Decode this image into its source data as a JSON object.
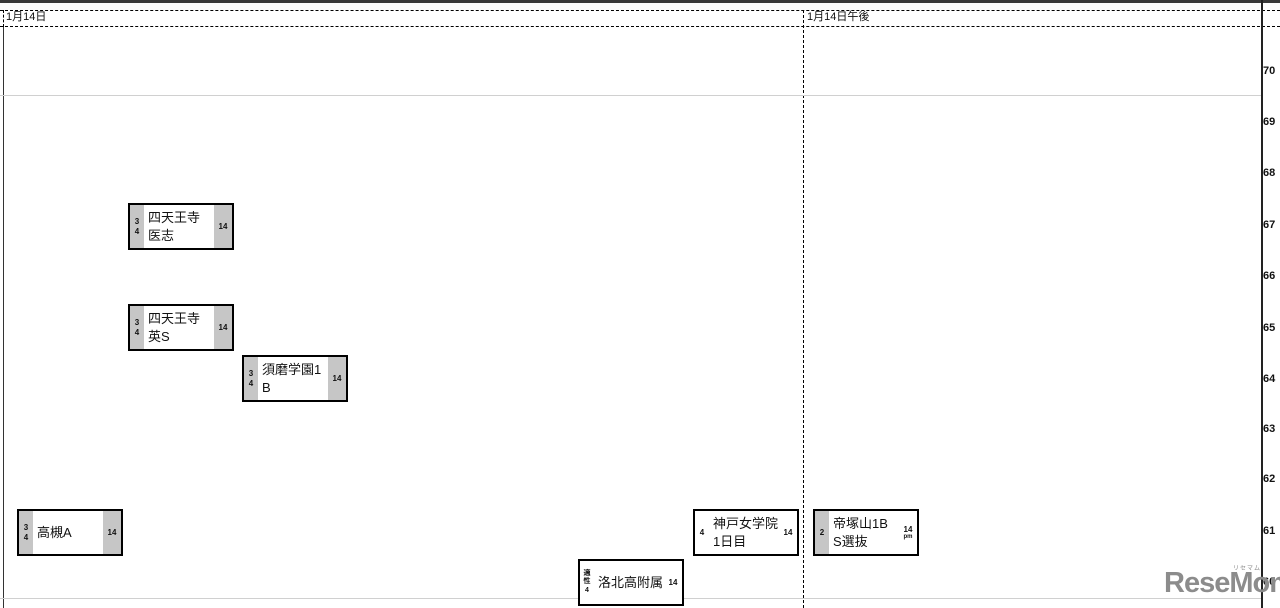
{
  "header": {
    "left_column_label": "1月14日",
    "right_column_label": "1月14日午後"
  },
  "axis": {
    "ticks": [
      "70",
      "69",
      "68",
      "67",
      "66",
      "65",
      "64",
      "63",
      "62",
      "61",
      "60"
    ]
  },
  "boxes": [
    {
      "name": "四天王寺\n医志",
      "left": "3\n4",
      "right": "14",
      "right_sub": ""
    },
    {
      "name": "四天王寺\n英S",
      "left": "3\n4",
      "right": "14",
      "right_sub": ""
    },
    {
      "name": "須磨学園1\nB",
      "left": "3\n4",
      "right": "14",
      "right_sub": ""
    },
    {
      "name": "高槻A",
      "left": "3\n4",
      "right": "14",
      "right_sub": ""
    },
    {
      "name": "神戸女学院\n1日目",
      "left": "4",
      "right": "14",
      "right_sub": ""
    },
    {
      "name": "帝塚山1B\nS選抜",
      "left": "2",
      "right": "14",
      "right_sub": "pm"
    },
    {
      "name": "洛北高附属",
      "left": "適\n性\n4",
      "right": "14",
      "right_sub": ""
    }
  ],
  "watermark": {
    "text": "ReseMom.",
    "ruby": "リセマム"
  },
  "colors": {
    "strip_gray": "#c6c6c6",
    "grid_light": "#d0d0d0",
    "box_border": "#000000",
    "watermark_gray": "#8c8c8c"
  },
  "chart_data": {
    "type": "scatter",
    "columns": [
      "1月14日",
      "1月14日午後"
    ],
    "ylabel": "",
    "ylim": [
      60,
      70
    ],
    "y_ticks": [
      70,
      69,
      68,
      67,
      66,
      65,
      64,
      63,
      62,
      61,
      60
    ],
    "grid": "dashed column separators, light band lines",
    "legend_position": "none",
    "points": [
      {
        "school": "四天王寺医志",
        "column": "1月14日",
        "value": 67,
        "left_code": "3 4",
        "right_code": "14"
      },
      {
        "school": "四天王寺英S",
        "column": "1月14日",
        "value": 65,
        "left_code": "3 4",
        "right_code": "14"
      },
      {
        "school": "須磨学園1B",
        "column": "1月14日",
        "value": 64,
        "left_code": "3 4",
        "right_code": "14"
      },
      {
        "school": "高槻A",
        "column": "1月14日",
        "value": 61,
        "left_code": "3 4",
        "right_code": "14"
      },
      {
        "school": "神戸女学院1日目",
        "column": "1月14日",
        "value": 61,
        "left_code": "4",
        "right_code": "14"
      },
      {
        "school": "帝塚山1B S選抜",
        "column": "1月14日午後",
        "value": 61,
        "left_code": "2",
        "right_code": "14 pm"
      },
      {
        "school": "洛北高附属",
        "column": "1月14日",
        "value": 60,
        "left_code": "適性 4",
        "right_code": "14"
      }
    ]
  }
}
